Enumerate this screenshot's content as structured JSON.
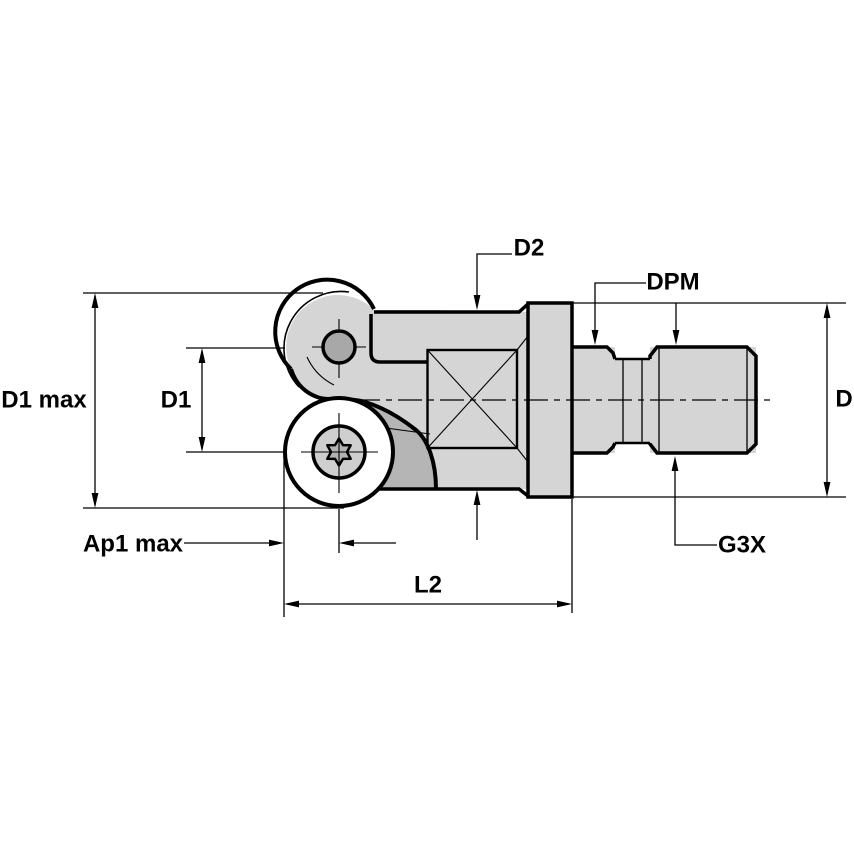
{
  "drawing": {
    "type": "technical-dimension-diagram",
    "subject": "indexable round-insert ball nose end mill, side view",
    "labels": {
      "d1_max": "D1 max",
      "d1": "D1",
      "ap1_max": "Ap1 max",
      "l2": "L2",
      "d2": "D2",
      "dpm": "DPM",
      "d": "D",
      "g3x": "G3X"
    },
    "colors": {
      "background": "#ffffff",
      "line": "#000000",
      "body_fill": "#d5d5d5",
      "flute_fill": "#b5b5b5",
      "screw_fill": "#a8a8a8",
      "insert_face_fill": "#ffffff",
      "counterbore_fill": "#cfcfcf",
      "torx_fill": "#b3b3b3"
    }
  }
}
